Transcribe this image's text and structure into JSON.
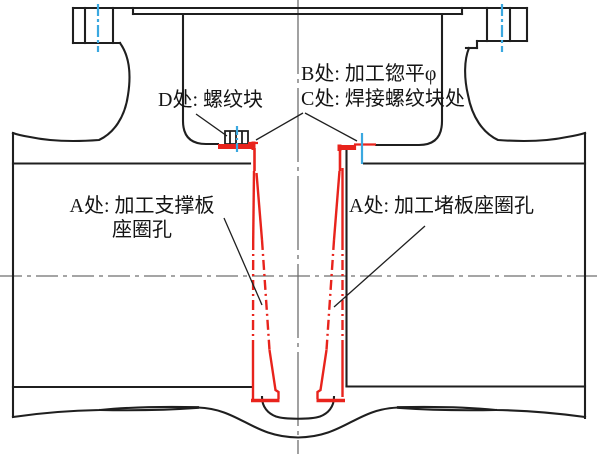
{
  "drawing": {
    "labels": {
      "b_note": "B处: 加工锪平φ",
      "c_note": "C处: 焊接螺纹块处",
      "d_note": "D处: 螺纹块",
      "a_left_note_line1": "A处: 加工支撑板",
      "a_left_note_line2": "座圈孔",
      "a_right_note": "A处: 加工堵板座圈孔"
    },
    "colors": {
      "outline": "#1f1f1f",
      "highlight_red": "#e8231c",
      "reference_blue": "#3aa8e0",
      "centerline_gray": "#6f6f6f",
      "background": "#ffffff"
    }
  }
}
